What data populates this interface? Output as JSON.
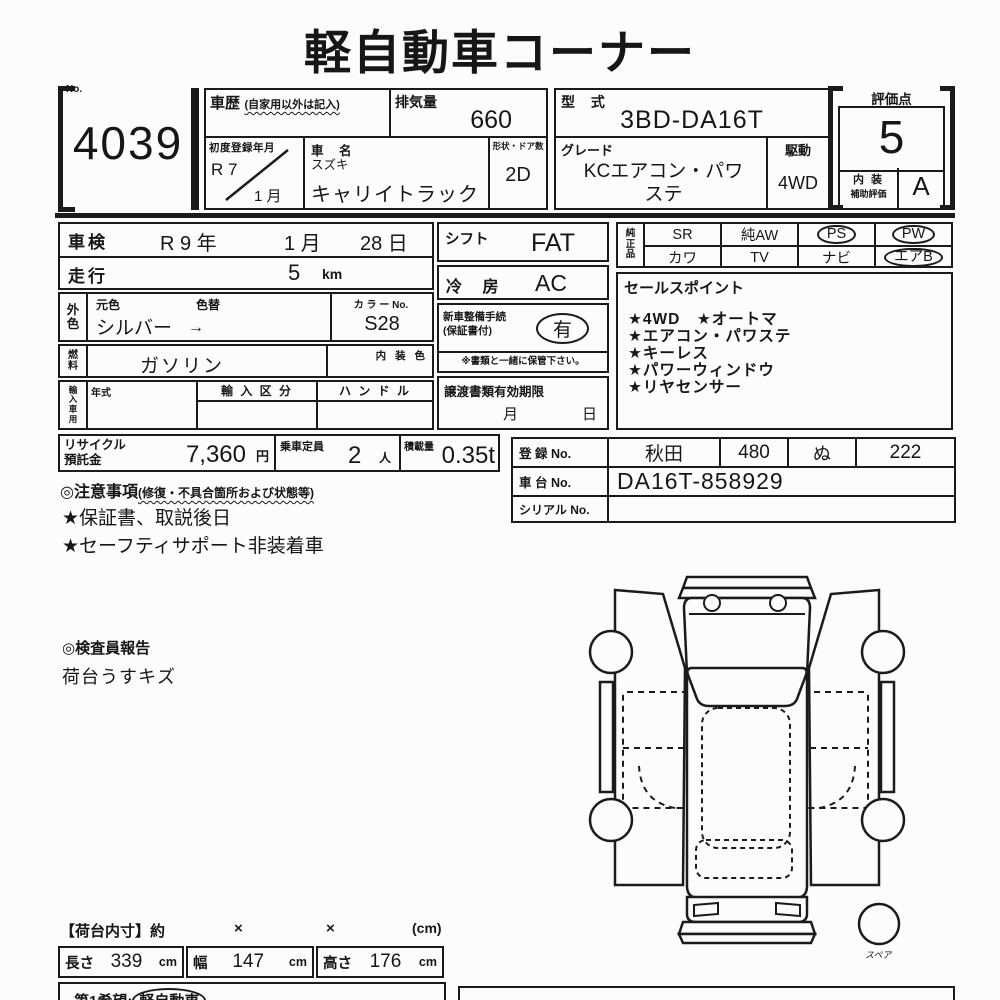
{
  "title": "軽自動車コーナー",
  "lot": {
    "no_label": "No.",
    "number": "4039"
  },
  "header": {
    "history": {
      "label": "車歴",
      "note": "(自家用以外は記入)"
    },
    "displacement": {
      "label": "排気量",
      "value": "660"
    },
    "model_code": {
      "label": "型 式",
      "value": "3BD-DA16T"
    },
    "first_registration": {
      "label": "初度登録年月",
      "year": "R 7",
      "month": "1 月"
    },
    "car_name": {
      "label": "車 名",
      "maker": "スズキ",
      "value": "キャリイトラック"
    },
    "shape_doors": {
      "label": "形状・ドア数",
      "value": "2D"
    },
    "grade": {
      "label": "グレード",
      "value": "KCエアコン・パワステ"
    },
    "drive": {
      "label": "駆動",
      "value": "4WD"
    }
  },
  "score": {
    "label": "評価点",
    "value": "5",
    "interior_label": "内 装",
    "interior_sublabel": "補助評価",
    "interior_value": "A"
  },
  "left_table": {
    "shaken": {
      "label": "車検",
      "year": "R 9 年",
      "month": "1 月",
      "day": "28 日"
    },
    "mileage": {
      "label": "走行",
      "value": "5",
      "unit": "km"
    },
    "color": {
      "side_label": "外色",
      "orig_label": "元色",
      "change_label": "色替",
      "value": "シルバー",
      "arrow": "→",
      "color_no_label": "カ ラ ー No.",
      "color_no": "S28"
    },
    "fuel": {
      "side_label": "燃料",
      "value": "ガソリン",
      "interior_color_label": "内 装 色"
    },
    "import": {
      "side_label": "輸入車用",
      "year_label": "年式",
      "class_label": "輸 入 区 分",
      "handle_label": "ハ ン ド ル"
    }
  },
  "mid_table": {
    "shift": {
      "label": "シフト",
      "value": "FAT"
    },
    "cooling": {
      "label": "冷 房",
      "value": "AC"
    },
    "procedure": {
      "label1": "新車整備手続",
      "label2": "(保証書付)",
      "value": "有",
      "note": "※書類と一緒に保管下さい。"
    },
    "transfer": {
      "label": "譲渡書類有効期限",
      "month": "月",
      "day": "日"
    }
  },
  "genuine": {
    "side_label": "純正品",
    "row1": [
      {
        "label": "SR",
        "circled": false
      },
      {
        "label": "純AW",
        "circled": false
      },
      {
        "label": "PS",
        "circled": true
      },
      {
        "label": "PW",
        "circled": true
      }
    ],
    "row2": [
      {
        "label": "カワ",
        "circled": false
      },
      {
        "label": "TV",
        "circled": false
      },
      {
        "label": "ナビ",
        "circled": false
      },
      {
        "label": "エアB",
        "circled": true
      }
    ]
  },
  "sales_points": {
    "label": "セールスポイント",
    "items": [
      "★4WD　★オートマ",
      "★エアコン・パワステ",
      "★キーレス",
      "★パワーウィンドウ",
      "★リヤセンサー"
    ]
  },
  "recycle": {
    "label1": "リサイクル",
    "label2": "預託金",
    "value": "7,360",
    "unit": "円"
  },
  "capacity": {
    "label": "乗車定員",
    "value": "2",
    "unit": "人"
  },
  "load": {
    "label": "積載量",
    "value": "0.35t"
  },
  "cautions": {
    "label": "◎注意事項",
    "note": "(修復・不具合箇所および状態等)",
    "items": [
      "★保証書、取説後日",
      "★セーフティサポート非装着車"
    ]
  },
  "registration": {
    "reg": {
      "label": "登 録 No.",
      "area": "秋田",
      "class_no": "480",
      "kana": "ぬ",
      "number": "222"
    },
    "chassis": {
      "label": "車 台 No.",
      "value": "DA16T-858929"
    },
    "serial": {
      "label": "シリアル No.",
      "value": ""
    }
  },
  "inspector": {
    "label": "◎検査員報告",
    "items": [
      "荷台うすキズ"
    ]
  },
  "diagram": {
    "spare_label": "スペア"
  },
  "bed_dimensions": {
    "title": "【荷台内寸】約",
    "x1": "×",
    "x2": "×",
    "unit_note": "(cm)",
    "length": {
      "label": "長さ",
      "value": "339",
      "unit": "cm"
    },
    "width": {
      "label": "幅",
      "value": "147",
      "unit": "cm"
    },
    "height": {
      "label": "高さ",
      "value": "176",
      "unit": "cm"
    }
  },
  "footer": {
    "first_choice_label": "第1希望:",
    "first_choice_value": "軽自動車"
  }
}
